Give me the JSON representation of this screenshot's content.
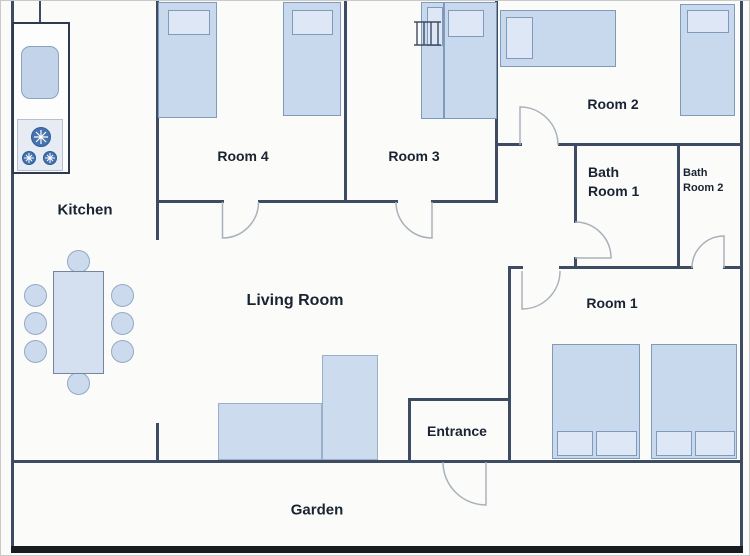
{
  "labels": {
    "kitchen": "Kitchen",
    "room4": "Room 4",
    "room3": "Room 3",
    "room2": "Room 2",
    "room1": "Room 1",
    "bath1": {
      "line1": "Bath",
      "line2": "Room 1"
    },
    "bath2": {
      "line1": "Bath",
      "line2": "Room 2"
    },
    "living": "Living Room",
    "entrance": "Entrance",
    "garden": "Garden"
  },
  "colors": {
    "wall": "#3e4c63",
    "wall_bottom": "#181b20",
    "bed_fill": "#c9d9ed",
    "bed_border": "#7f9aba",
    "pillow_fill": "#dde7f6",
    "door_arc": "#a9b1ba",
    "burner": "#4673ae",
    "text": "#1a2332",
    "background": "#fbfbfa"
  },
  "furniture": {
    "kitchen": [
      "counter with sink",
      "stove with 3 burners",
      "dining table with 8 chairs"
    ],
    "room4": [
      "single bed",
      "single bed"
    ],
    "room3": [
      "bed with ladder"
    ],
    "room2": [
      "single bed horizontal",
      "single bed vertical"
    ],
    "room1": [
      "double bed with 2 pillows",
      "double bed with 2 pillows"
    ],
    "living_room": [
      "corner sofa"
    ],
    "doors": [
      "room4-door",
      "room3-door",
      "room2-door",
      "bath-room1-door",
      "bath-room2-door",
      "room1-door",
      "entrance-garden-door"
    ]
  }
}
